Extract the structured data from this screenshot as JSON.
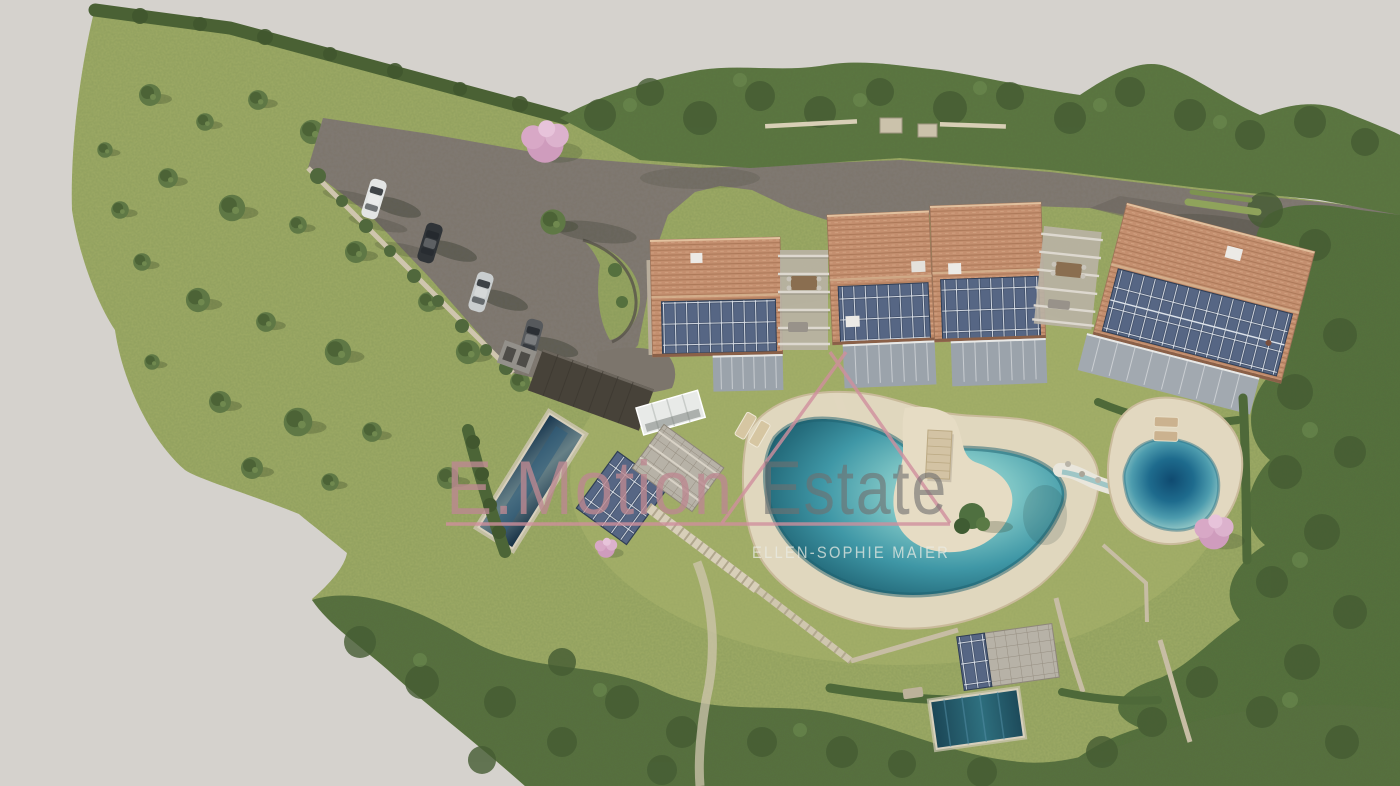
{
  "watermark": {
    "brand_word_1": "E.Motion",
    "brand_word_2": "Estate",
    "subtitle": "ELLEN-SOPHIE MAIER",
    "accent_pink": "#d08f9d",
    "brand_word_1_color": "#bb8891",
    "brand_word_2_color": "#6f6f6f"
  },
  "scene": {
    "type": "aerial-architectural-rendering",
    "labels": {
      "grounds": "landscaped hillside grounds",
      "access_road": "asphalt access road and parking court",
      "cars": "parked cars",
      "residences": "terraced residences with tiled roofs and solar panels",
      "natural_pond": "natural swimming pond with sand beach and jetty",
      "biotope_pond": "biotope plunge pond",
      "lap_pool": "lap pool",
      "plunge_pool": "lower garden pool",
      "garage": "garage with dark flat roof",
      "carport": "solar carport and stone terraces",
      "flowering_trees": "pink flowering trees",
      "olive_grove": "olive grove meadow"
    },
    "counts": {
      "cars": 4,
      "residential_buildings": 4,
      "ponds": 2,
      "pools": 2,
      "flowering_trees": 3
    },
    "palette": {
      "background": "#d5d2cd",
      "meadow": "#9fab66",
      "forest": "#57723f",
      "asphalt": "#7c756c",
      "roof_tile": "#c48f6f",
      "solar_panel": "#4e5e7a",
      "sand": "#e2d8c0",
      "pond_water": "#3f97a6",
      "deep_water": "#14537a",
      "pool_water": "#1d3f59",
      "stone": "#c9bfa8",
      "blossom": "#d6a5c3"
    }
  }
}
